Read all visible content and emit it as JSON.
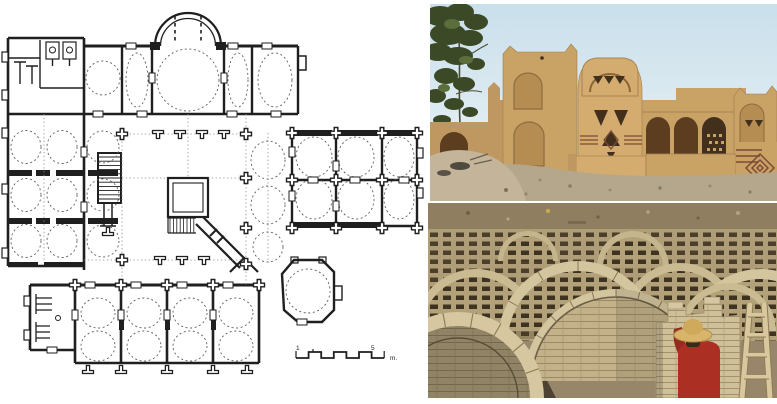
{
  "plan": {
    "scale_bar": {
      "start_label": "1",
      "end_label": "5",
      "unit": "m."
    }
  },
  "colors": {
    "paper": "#ffffff",
    "ink": "#1f1f1f",
    "dome": "#5e5e5e",
    "guide": "#8a8a8a",
    "sky_top": "#c9dfeb",
    "sky_bot": "#eef4f7",
    "foliage": "#3c4926",
    "foliage_light": "#5c6e3c",
    "branch": "#4a4a32",
    "adobe": "#c9a266",
    "adobe_light": "#d4ac70",
    "adobe_deep": "#bf9760",
    "niche": "#b58c52",
    "arch_dark": "#5c3d20",
    "opening": "#42301c",
    "sand": "#b5a78c",
    "mound": "#c3b49a",
    "dirt": "#8f7e60",
    "vault_base": "#97866a",
    "rib": "#d3c59e",
    "rib_edge": "#8a7856",
    "brick_light": "#cfc09a",
    "brick_mid": "#b2a179",
    "lattice_hole": "#3e3320",
    "shadow_warm": "#5a4c38",
    "shirt": "#ab2f23",
    "hat": "#d8b569",
    "wood": "#d9c89e",
    "stripe": "#7e4a34"
  }
}
